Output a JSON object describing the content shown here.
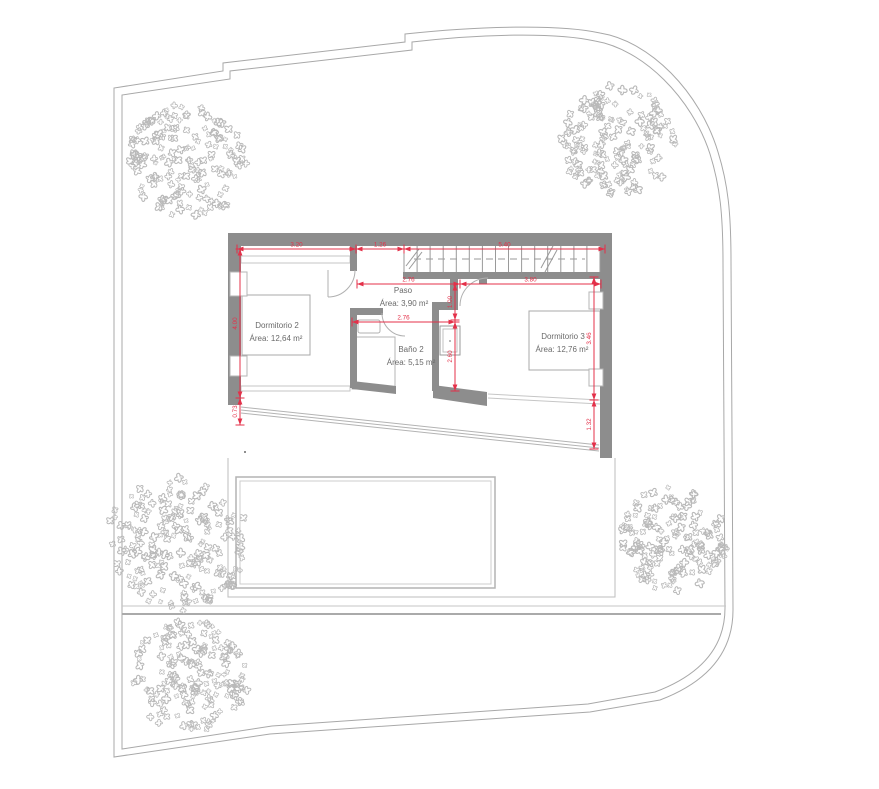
{
  "drawing": {
    "kind": "architectural-floor-plan",
    "colors": {
      "dimension_red": "#e43049",
      "wall_dark": "#8d8d8d",
      "wall_light": "#bdbdbd",
      "outline_gray": "#a8a8a8",
      "leaf_gray": "#b9b9b9",
      "label_gray": "#6a6a6a"
    }
  },
  "plan": {
    "rooms": [
      {
        "name": "Dormitorio 2",
        "area": "Área: 12,64 m²"
      },
      {
        "name": "Paso",
        "area": "Área: 3,90 m²"
      },
      {
        "name": "Baño 2",
        "area": "Área: 5,15 m²"
      },
      {
        "name": "Dormitorio 3",
        "area": "Área: 12,76 m²"
      }
    ],
    "dimensions": [
      {
        "label": "3.20",
        "dir": "h",
        "x1": 237,
        "x2": 356,
        "y": 249
      },
      {
        "label": "1.26",
        "dir": "h",
        "x1": 356,
        "x2": 404,
        "y": 249
      },
      {
        "label": "5.40",
        "dir": "h",
        "x1": 404,
        "x2": 605,
        "y": 249
      },
      {
        "label": "2.76",
        "dir": "h",
        "x1": 357,
        "x2": 460,
        "y": 284
      },
      {
        "label": "3.80",
        "dir": "h",
        "x1": 460,
        "x2": 601,
        "y": 284
      },
      {
        "label": "2.76",
        "dir": "h",
        "x1": 352,
        "x2": 455,
        "y": 322
      },
      {
        "label": "4.00",
        "dir": "v",
        "x": 240,
        "y1": 249,
        "y2": 398
      },
      {
        "label": "0.73",
        "dir": "v",
        "x": 240,
        "y1": 398,
        "y2": 425
      },
      {
        "label": "1.00",
        "dir": "v",
        "x": 455,
        "y1": 284,
        "y2": 320
      },
      {
        "label": "2.60",
        "dir": "v",
        "x": 455,
        "y1": 322,
        "y2": 391
      },
      {
        "label": "3.46",
        "dir": "v",
        "x": 594,
        "y1": 277,
        "y2": 400
      },
      {
        "label": "1.32",
        "dir": "v",
        "x": 594,
        "y1": 400,
        "y2": 449
      }
    ],
    "stairs": {
      "x1": 404,
      "x2": 600,
      "y1": 246,
      "y2": 272,
      "treads": 15
    }
  },
  "site": {
    "trees": [
      {
        "cx": 187,
        "cy": 160,
        "r": 62
      },
      {
        "cx": 618,
        "cy": 140,
        "r": 60
      },
      {
        "cx": 178,
        "cy": 543,
        "r": 73
      },
      {
        "cx": 190,
        "cy": 676,
        "r": 61
      },
      {
        "cx": 674,
        "cy": 539,
        "r": 57
      }
    ],
    "leaf_seed": 42
  }
}
